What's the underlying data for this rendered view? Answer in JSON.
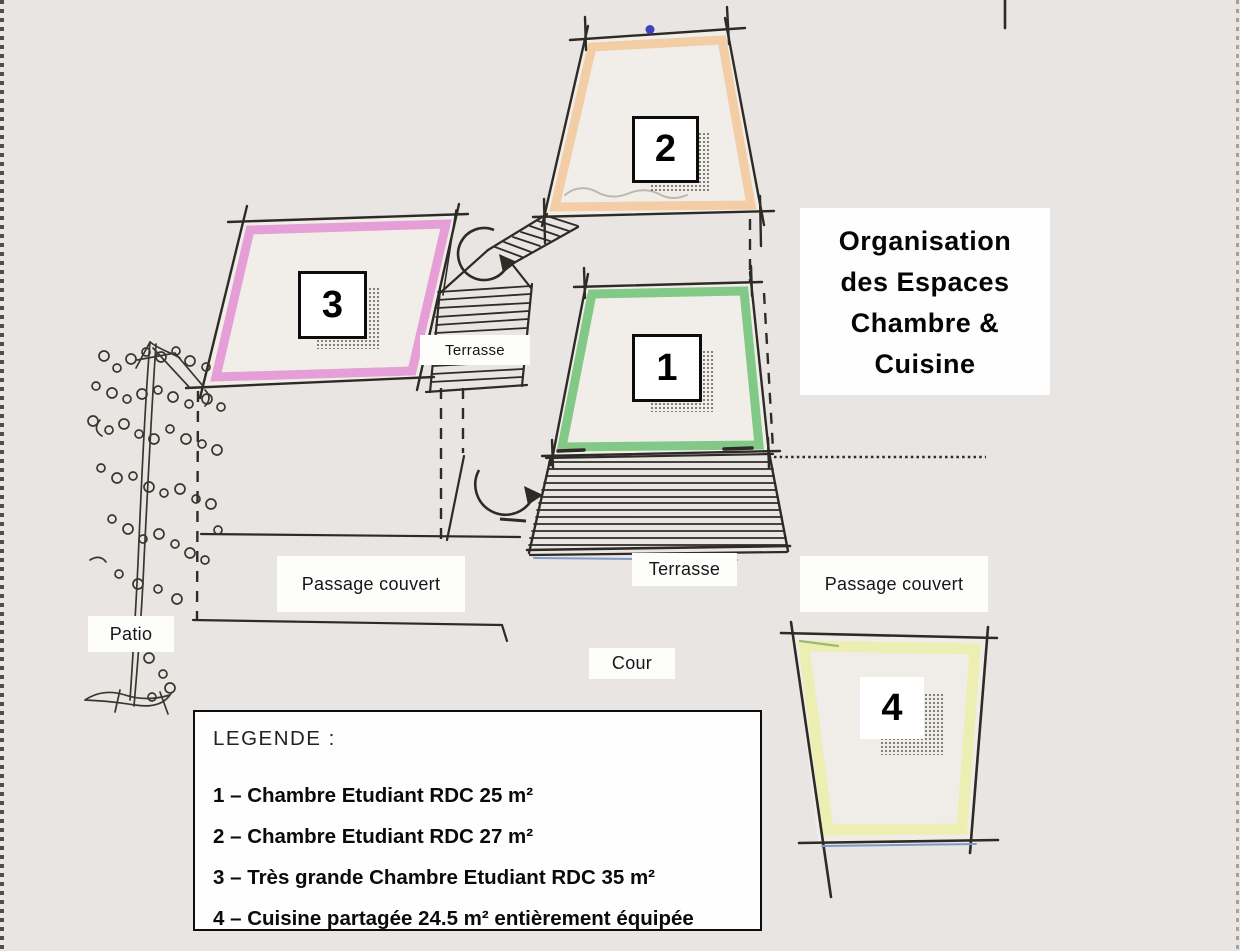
{
  "title": {
    "lines": [
      "Organisation",
      "des Espaces",
      "Chambre &",
      "Cuisine"
    ]
  },
  "legend": {
    "heading": "LEGENDE :",
    "items": [
      "1 – Chambre Etudiant RDC 25 m²",
      "2 – Chambre Etudiant RDC 27 m²",
      "3 – Très grande Chambre Etudiant RDC 35 m²",
      "4 – Cuisine partagée 24.5 m² entièrement équipée"
    ]
  },
  "rooms": [
    {
      "number": "1",
      "outline_color": "#82c886"
    },
    {
      "number": "2",
      "outline_color": "#f3cda6"
    },
    {
      "number": "3",
      "outline_color": "#e59ed6"
    },
    {
      "number": "4",
      "outline_color": "#edefb2"
    }
  ],
  "labels": {
    "terrasse_upper": "Terrasse",
    "terrasse_lower": "Terrasse",
    "passage_couvert_left": "Passage couvert",
    "passage_couvert_right": "Passage couvert",
    "patio": "Patio",
    "cour": "Cour"
  },
  "colors": {
    "background": "#e9e5e2",
    "ink": "#2e2b27",
    "blue_dot": "#4040bd",
    "blue_accent_line": "#7d9bc7"
  }
}
